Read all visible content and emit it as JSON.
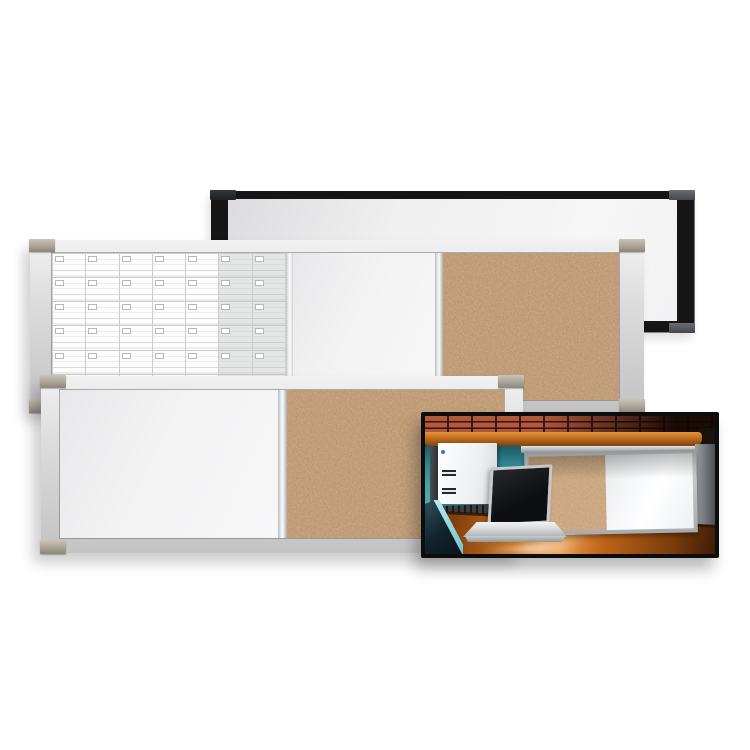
{
  "meta": {
    "description": "Product photo of combination dry-erase, cork and planner wall boards with an office-cubicle installation inset photo",
    "background_color": "#ffffff",
    "visible_text": "none"
  },
  "products": {
    "black_board": {
      "name": "black-frame dry-erase board",
      "frame_color": "#151515",
      "surface_color": "#f2f2f3",
      "corner_cap_color": "#55595d"
    },
    "planner_combo_board": {
      "name": "aluminum-frame combination board with monthly planner grid, dry-erase panel and cork panel",
      "frame_color": "#d7d7d7",
      "corner_cap_color": "#aaa497",
      "planner_grid": {
        "columns": 7,
        "rows": 6,
        "shaded_weekend_columns": 2,
        "line_color": "#cbcbcb",
        "weekend_fill": "#e4e5e5",
        "date_box_color": "#ffffff",
        "rail_mark_count": 9,
        "rail_mark_color": "#54575b"
      },
      "dry_erase_color": "#f4f4f5",
      "cork_color": "#c1976a"
    },
    "cork_combo_board": {
      "name": "aluminum-frame combination board with dry-erase panel and cork panel",
      "frame_color": "#d7d7d7",
      "corner_cap_color": "#aaa497",
      "dry_erase_color": "#f3f3f4",
      "cork_color": "#c29768"
    },
    "inset_photo": {
      "name": "combination board mounted above a cubicle desk",
      "border_color": "#0d0d0d",
      "elements": [
        "brick wall",
        "wood overhead shelf",
        "teal cubicle partition",
        "cork and dry-erase wall board",
        "white binder",
        "black keyboard",
        "silver laptop",
        "wood desk surface",
        "chair back",
        "gray end panel"
      ],
      "colors": {
        "brick": "#b5573a",
        "mortar": "#2f150c",
        "shelf_wood": "#c4701f",
        "partition_teal": "#3d98a0",
        "cork": "#cfa678",
        "dry_erase": "#f6f8fa",
        "desk_wood": "#d97f2a",
        "laptop_body": "#d7d9db",
        "laptop_screen": "#141619",
        "binder": "#f2f3f5",
        "end_panel": "#7b7e82"
      }
    }
  }
}
